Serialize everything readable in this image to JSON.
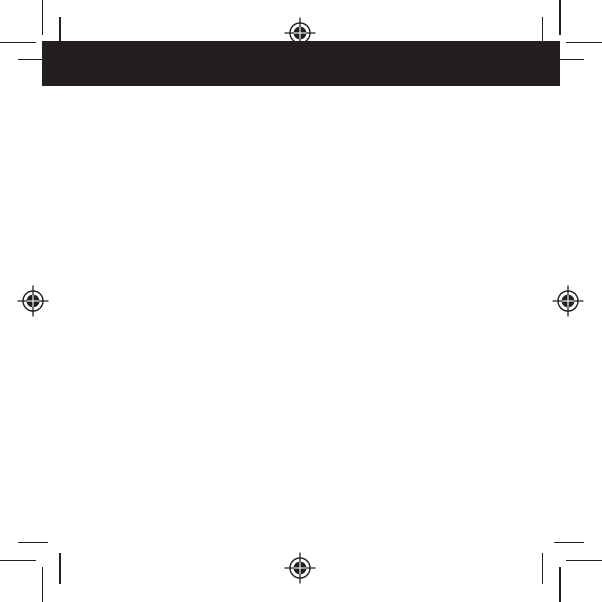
{
  "document": {
    "type": "print-proof-page",
    "description": "Blank print layout page with black header band, corner crop marks and registration targets; no visible text"
  },
  "colors": {
    "ink": "#231f20",
    "paper": "#ffffff"
  },
  "banner": {
    "text": ""
  },
  "registration_marks": [
    {
      "id": "top-center",
      "x": 300,
      "y": 33
    },
    {
      "id": "middle-left",
      "x": 33,
      "y": 301
    },
    {
      "id": "middle-right",
      "x": 568,
      "y": 301
    },
    {
      "id": "bottom-center",
      "x": 300,
      "y": 568
    }
  ],
  "crop_mark_corners": [
    "top-left",
    "top-right",
    "bottom-left",
    "bottom-right"
  ]
}
